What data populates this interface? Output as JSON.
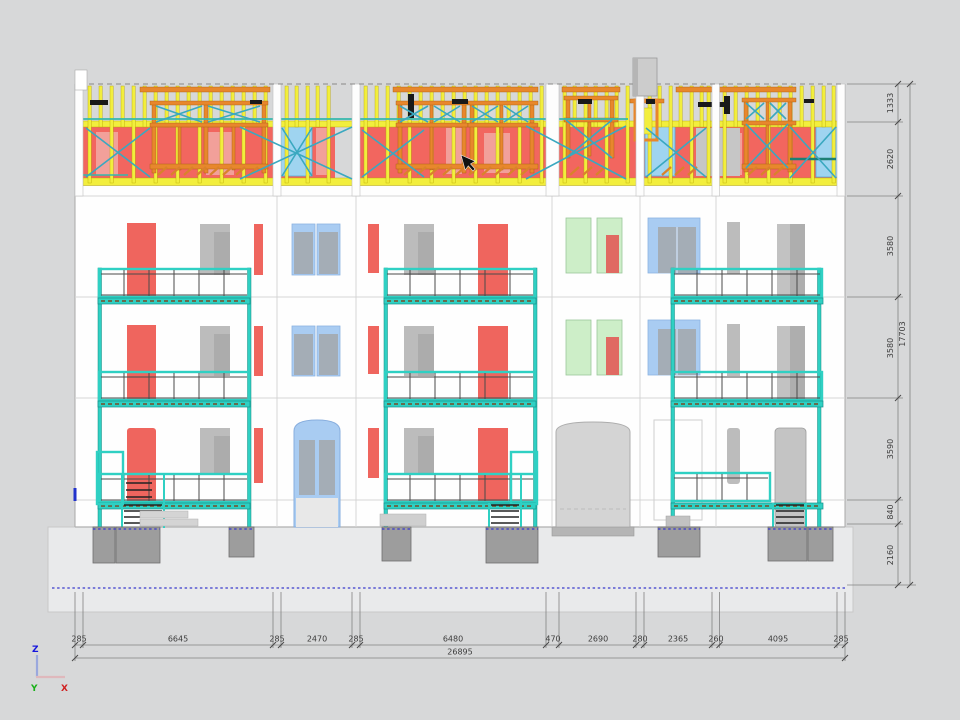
{
  "drawing": {
    "description": "CAD building elevation with timber-frame attic storey, three balconies and dimension chains",
    "axis_gizmo": {
      "z": "Z",
      "y": "Y",
      "x": "X"
    }
  },
  "dimensions": {
    "bottom": [
      "285",
      "6645",
      "285",
      "2470",
      "285",
      "6480",
      "470",
      "2690",
      "280",
      "2365",
      "260",
      "4095",
      "285"
    ],
    "bottom_total": "26895",
    "right": [
      "1333",
      "2620",
      "3580",
      "3580",
      "3590",
      "840",
      "2160"
    ],
    "right_total": "17703"
  },
  "colors": {
    "background": "#d7d8d9",
    "facade": "#fefefe",
    "stud_yellow": "#f2ee3d",
    "frame_orange": "#e8872c",
    "panel_red": "#f2665f",
    "panel_pink": "#f2a09a",
    "panel_skyblue": "#9fd4f0",
    "window_blue": "#a9ccf2",
    "window_green": "#cdeec8",
    "balcony_teal": "#2fd0c3",
    "brace_cyan": "#3aa8c0",
    "foundation_gray": "#9d9d9d",
    "dashed_blue": "#3a3acc",
    "axis_z": "#1515dd",
    "axis_y": "#18b018",
    "axis_x": "#d02020"
  }
}
